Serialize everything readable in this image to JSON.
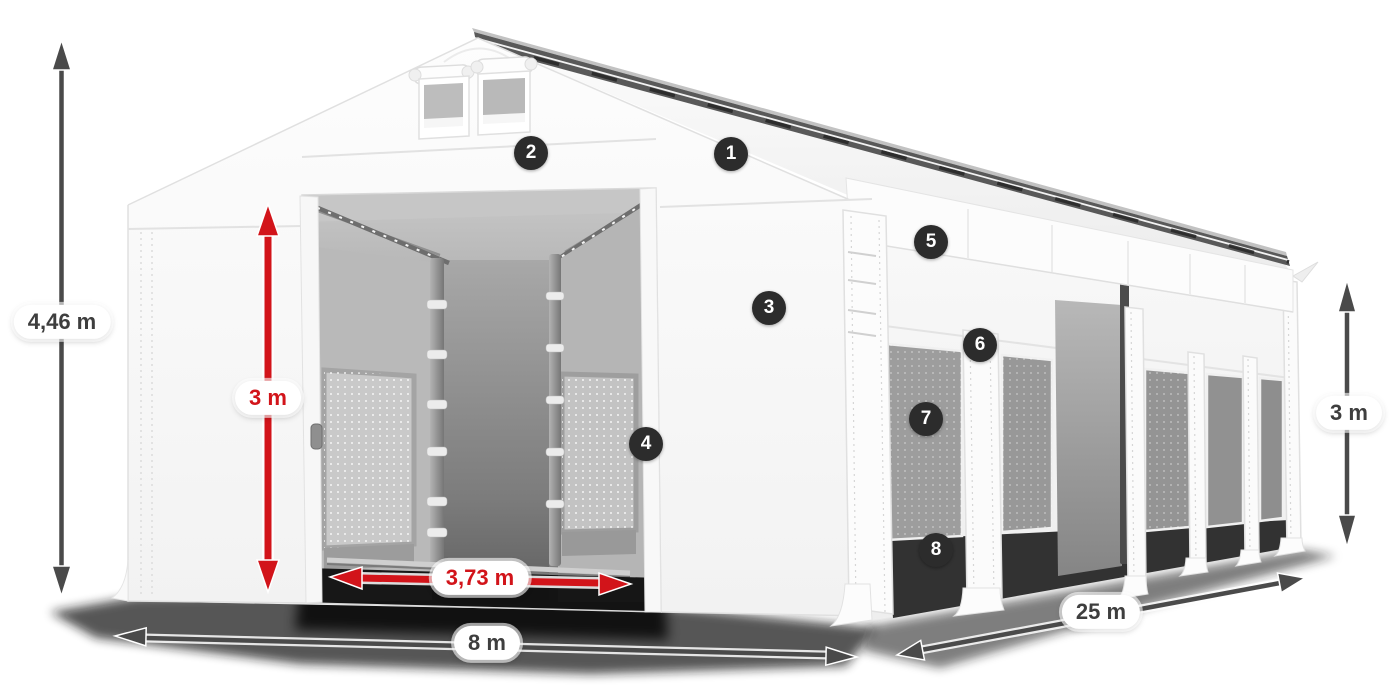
{
  "diagram": {
    "dimension_labels": {
      "total_height": "4,46 m",
      "inner_height": "3 m",
      "door_width": "3,73 m",
      "front_width": "8 m",
      "side_length": "25 m",
      "side_wall_height": "3 m"
    },
    "callout_markers": [
      {
        "number": "1"
      },
      {
        "number": "2"
      },
      {
        "number": "3"
      },
      {
        "number": "4"
      },
      {
        "number": "5"
      },
      {
        "number": "6"
      },
      {
        "number": "7"
      },
      {
        "number": "8"
      }
    ],
    "colors": {
      "red_dimension": "#d2141a",
      "gray_dimension": "#4a4a4a",
      "marker_background": "#2c2c2c",
      "marker_number": "#ffffff",
      "label_text": "#3e3e3e",
      "label_background": "#ffffff"
    }
  }
}
